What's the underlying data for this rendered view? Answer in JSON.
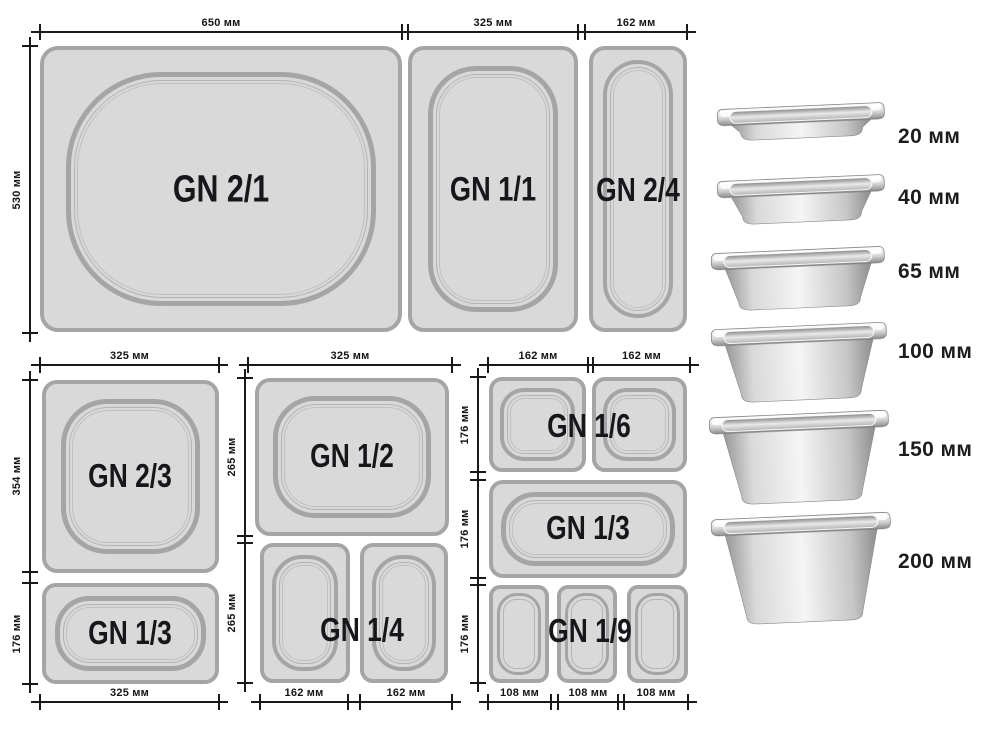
{
  "colors": {
    "pan_fill": "#d9d9d9",
    "pan_border": "#a5a5a5",
    "dimension_line": "#191919",
    "label_text": "#17171b",
    "background": "#ffffff"
  },
  "diagram": {
    "gn_labels": {
      "gn21": "GN 2/1",
      "gn11": "GN 1/1",
      "gn24": "GN 2/4",
      "gn23": "GN 2/3",
      "gn13a": "GN 1/3",
      "gn12": "GN 1/2",
      "gn14": "GN 1/4",
      "gn16": "GN 1/6",
      "gn13b": "GN 1/3",
      "gn19": "GN 1/9"
    },
    "h_dims": {
      "t650": "650 мм",
      "t325": "325 мм",
      "t162": "162 мм",
      "g2t": "325 мм",
      "g2b": "325 мм",
      "g3t": "325 мм",
      "g3ba": "162 мм",
      "g3bb": "162 мм",
      "g4ta": "162 мм",
      "g4tb": "162 мм",
      "g4ba": "108 мм",
      "g4bb": "108 мм",
      "g4bc": "108 мм"
    },
    "v_dims": {
      "v530": "530 мм",
      "v354": "354 мм",
      "v176a": "176 мм",
      "v265a": "265 мм",
      "v265b": "265 мм",
      "v176b": "176 мм",
      "v176c": "176 мм",
      "v176d": "176 мм"
    }
  },
  "depth_panel": {
    "labels": {
      "p20": "20 мм",
      "p40": "40 мм",
      "p65": "65 мм",
      "p100": "100 мм",
      "p150": "150 мм",
      "p200": "200 мм"
    }
  }
}
